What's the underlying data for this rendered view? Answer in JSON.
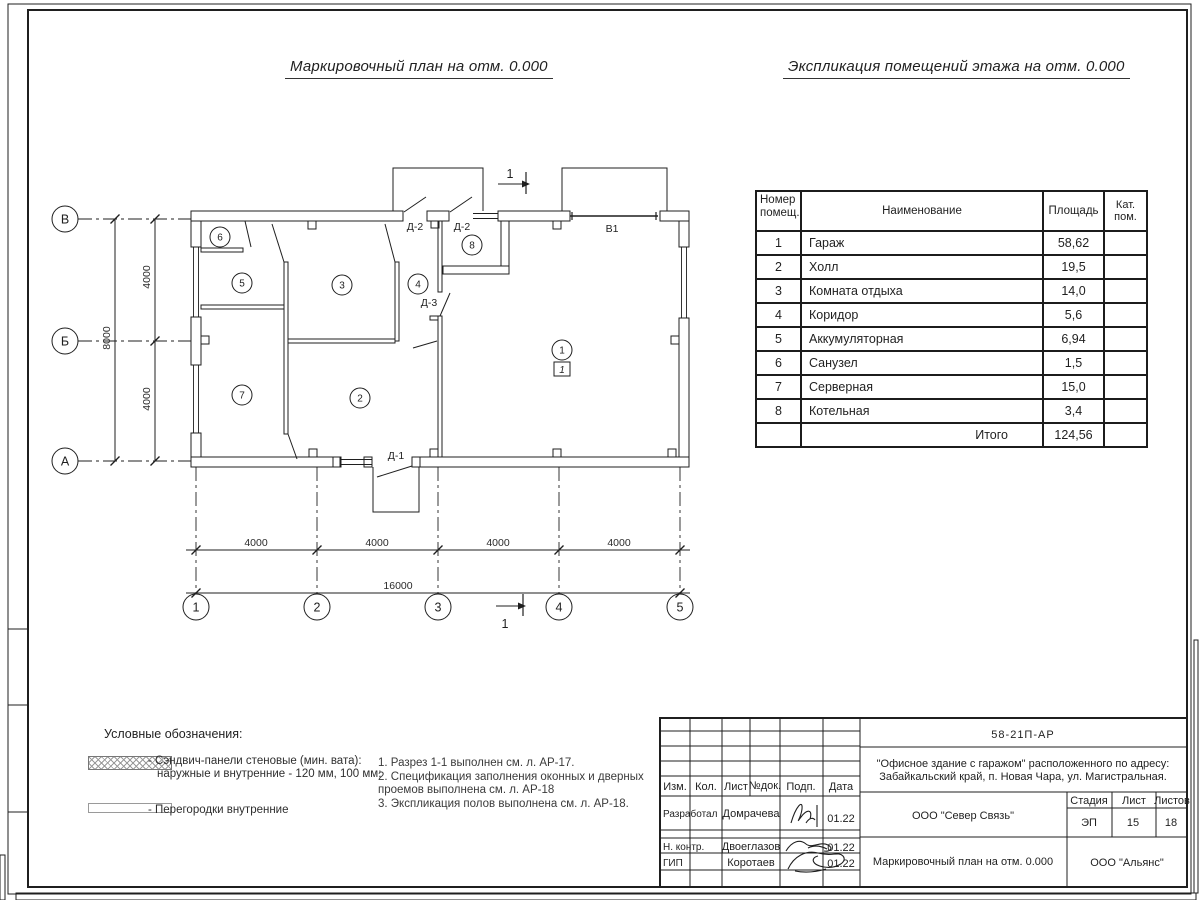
{
  "titles": {
    "plan": "Маркировочный план на отм. 0.000",
    "explication": "Экспликация помещений этажа на отм. 0.000"
  },
  "explication": {
    "headers": {
      "num1": "Номер",
      "num2": "помещ.",
      "name": "Наименование",
      "area": "Площадь",
      "cat1": "Кат.",
      "cat2": "пом."
    },
    "rows": [
      {
        "num": "1",
        "name": "Гараж",
        "area": "58,62",
        "cat": ""
      },
      {
        "num": "2",
        "name": "Холл",
        "area": "19,5",
        "cat": ""
      },
      {
        "num": "3",
        "name": "Комната отдыха",
        "area": "14,0",
        "cat": ""
      },
      {
        "num": "4",
        "name": "Коридор",
        "area": "5,6",
        "cat": ""
      },
      {
        "num": "5",
        "name": "Аккумуляторная",
        "area": "6,94",
        "cat": ""
      },
      {
        "num": "6",
        "name": "Санузел",
        "area": "1,5",
        "cat": ""
      },
      {
        "num": "7",
        "name": "Серверная",
        "area": "15,0",
        "cat": ""
      },
      {
        "num": "8",
        "name": "Котельная",
        "area": "3,4",
        "cat": ""
      }
    ],
    "total_label": "Итого",
    "total_area": "124,56"
  },
  "plan": {
    "axis_letters": [
      "В",
      "Б",
      "А"
    ],
    "axis_numbers": [
      "1",
      "2",
      "3",
      "4",
      "5"
    ],
    "dims_bottom": [
      "4000",
      "4000",
      "4000",
      "4000"
    ],
    "dim_bottom_total": "16000",
    "dims_left": [
      "4000",
      "4000"
    ],
    "dim_left_total": "8000",
    "rooms": [
      "1",
      "2",
      "3",
      "4",
      "5",
      "6",
      "7",
      "8"
    ],
    "labels": {
      "d1": "Д-1",
      "d2": "Д-2",
      "d3": "Д-3",
      "v1": "В1",
      "section": "1",
      "floor_mark": "1"
    }
  },
  "legend": {
    "title": "Условные обозначения:",
    "item1_line1": "- Сэндвич-панели стеновые (мин. вата):",
    "item1_line2": "наружные и внутренние - 120 мм, 100 мм;",
    "item2": "- Перегородки внутренние"
  },
  "notes": {
    "line1": "1. Разрез 1-1 выполнен см. л. АР-17.",
    "line2": "2. Спецификация заполнения оконных и дверных",
    "line3": "проемов выполнена см. л. АР-18",
    "line4": "3. Экспликация полов выполнена см. л. АР-18."
  },
  "stamp": {
    "doc_number": "58-21П-АР",
    "address_line1": "\"Офисное здание с гаражом\" расположенного по адресу:",
    "address_line2": "Забайкальский край, п. Новая Чара, ул. Магистральная.",
    "col_izm": "Изм.",
    "col_kol": "Кол.",
    "col_list": "Лист",
    "col_ndok": "№док.",
    "col_podp": "Подп.",
    "col_data": "Дата",
    "rows": [
      {
        "role": "Разработал",
        "name": "Домрачева",
        "date": "01.22"
      },
      {
        "role": "Н. контр.",
        "name": "Двоеглазов",
        "date": "01.22"
      },
      {
        "role": "ГИП",
        "name": "Коротаев",
        "date": "01.22"
      }
    ],
    "org": "ООО \"Север Связь\"",
    "stage_label": "Стадия",
    "sheet_label": "Лист",
    "sheets_label": "Листов",
    "stage": "ЭП",
    "sheet": "15",
    "sheets": "18",
    "drawing_title": "Маркировочный план на отм. 0.000",
    "company": "ООО \"Альянс\""
  },
  "colors": {
    "ink": "#1f1f1f",
    "paper": "#ffffff"
  }
}
